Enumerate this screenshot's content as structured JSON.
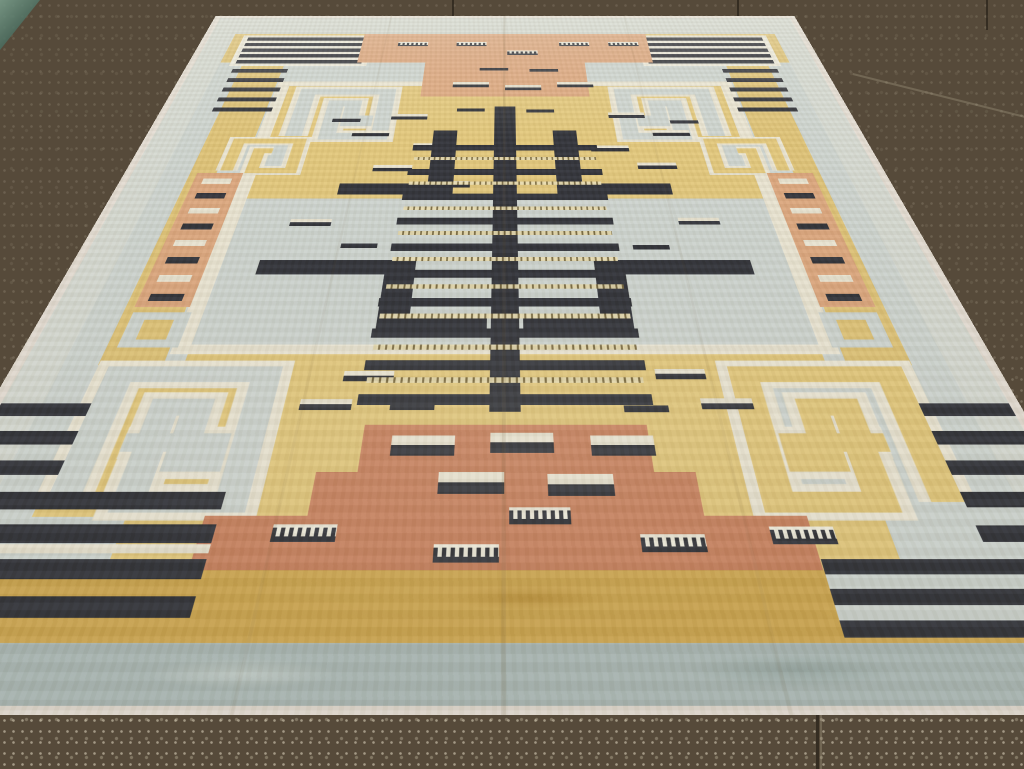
{
  "scene": {
    "type": "photograph",
    "subject": "Art Deco geometric rug displayed flat on a dark speckled stone floor",
    "view": "perspective from the near (bottom) edge, rug receding toward top",
    "floor": "dark olive-brown terrazzo tiles, darker and stained at top, lighter with white speckles at bottom, faint tile joints",
    "reflection": "small teal glass reflection in extreme top-left corner"
  },
  "palette": {
    "binding": "#e4ddd3",
    "outer": "#d6dad2",
    "icy": "#ced5d0",
    "cream": "#eae5d3",
    "white": "#efecdd",
    "yellow": "#dfc377",
    "yellow2": "#e3c87c",
    "salmon": "#dda77e",
    "terra": "#c9825f",
    "navy": "#2f3138",
    "blue": "#abb9b6"
  },
  "rug": {
    "flat_width": 1390,
    "flat_height": 2190,
    "projection": {
      "perspective": 1005,
      "rotateX_deg": 40,
      "bottom_screen_y": 715,
      "center_screen_x": 505
    },
    "ladder": {
      "spine": [
        674,
        575,
        42,
        1085
      ],
      "rungs": [
        [
          520,
          770,
          350
        ],
        [
          517,
          880,
          356
        ],
        [
          514,
          985,
          362
        ],
        [
          511,
          1080,
          368
        ],
        [
          508,
          1175,
          374
        ],
        [
          505,
          1265,
          380
        ],
        [
          502,
          1355,
          386
        ],
        [
          499,
          1445,
          392
        ],
        [
          497,
          1532,
          396
        ],
        [
          495,
          1618,
          400
        ]
      ],
      "ticks": [
        [
          525,
          826,
          340
        ],
        [
          522,
          934,
          346
        ],
        [
          519,
          1036,
          352
        ],
        [
          516,
          1130,
          358
        ],
        [
          513,
          1222,
          364
        ],
        [
          510,
          1312,
          370
        ],
        [
          507,
          1402,
          376
        ],
        [
          505,
          1490,
          380
        ],
        [
          503,
          1576,
          384
        ]
      ]
    },
    "motifs": [
      [
        "rect",
        0,
        0,
        1390,
        2190,
        "binding",
        "rug-binding"
      ],
      [
        "rect",
        14,
        14,
        1362,
        2162,
        "outer",
        "outer-band"
      ],
      [
        "rect",
        70,
        315,
        1250,
        1660,
        "icy",
        "icy-ground"
      ],
      [
        "rect",
        70,
        130,
        1250,
        190,
        "yellow",
        "top-yellow-band"
      ],
      [
        "rect",
        120,
        315,
        92,
        1230,
        "yellow",
        "left-yellow-band"
      ],
      [
        "rect",
        1178,
        315,
        92,
        1230,
        "yellow",
        "right-yellow-band"
      ],
      [
        "rect",
        14,
        1975,
        1362,
        115,
        "ochre",
        "bottom-ochre-band"
      ],
      [
        "rect",
        14,
        2090,
        1362,
        88,
        "blueb",
        "bottom-blue-band"
      ],
      [
        "rect",
        215,
        435,
        960,
        26,
        "cream",
        "field-frame-top"
      ],
      [
        "rect",
        215,
        435,
        26,
        1080,
        "cream",
        "field-frame-left"
      ],
      [
        "rect",
        1149,
        435,
        26,
        1080,
        "cream",
        "field-frame-right"
      ],
      [
        "rect",
        241,
        461,
        908,
        544,
        "yellow2",
        "upper-yellow-field"
      ],
      [
        "rect",
        215,
        1490,
        960,
        26,
        "cream",
        "field-frame-bottom"
      ],
      [
        "rect",
        241,
        1516,
        908,
        459,
        "yellow2",
        "lower-yellow-field"
      ],
      [
        "rect",
        92,
        140,
        300,
        200,
        "white",
        "tl-stripe-panel"
      ],
      [
        "bars",
        104,
        154,
        276,
        0,
        "navy",
        {
          "n": 5,
          "h": 22,
          "gap": 15
        },
        "tl-long-stripes"
      ],
      [
        "rect",
        998,
        140,
        300,
        200,
        "white",
        "tr-stripe-panel"
      ],
      [
        "bars",
        1010,
        154,
        276,
        0,
        "navy",
        {
          "n": 5,
          "h": 22,
          "gap": 15
        },
        "tr-long-stripes"
      ],
      [
        "bars",
        104,
        360,
        120,
        0,
        "navy",
        {
          "n": 5,
          "h": 22,
          "gap": 33
        },
        "left-short-ladder"
      ],
      [
        "bars",
        1166,
        360,
        120,
        0,
        "navy",
        {
          "n": 5,
          "h": 22,
          "gap": 33
        },
        "right-short-ladder"
      ],
      [
        "rect",
        370,
        130,
        650,
        190,
        "salmon",
        "top-salmon-block"
      ],
      [
        "rect",
        520,
        320,
        350,
        200,
        "salmon",
        "top-salmon-step"
      ],
      [
        "comb",
        452,
        185,
        68,
        28
      ],
      [
        "comb",
        585,
        185,
        68,
        28
      ],
      [
        "comb",
        700,
        242,
        68,
        28
      ],
      [
        "comb",
        818,
        185,
        68,
        28
      ],
      [
        "comb",
        930,
        185,
        68,
        28
      ],
      [
        "dash",
        640,
        352,
        62,
        16
      ],
      [
        "dash",
        748,
        360,
        62,
        16
      ],
      [
        "tt",
        585,
        438,
        76,
        30
      ],
      [
        "tt",
        695,
        455,
        76,
        30
      ],
      [
        "tt",
        805,
        438,
        76,
        30
      ],
      [
        "spiral",
        262,
        470,
        212,
        280,
        null,
        {
          "stroke": "icy",
          "casing": "cream",
          "dir": 1,
          "loops": 2.2
        },
        "tl-greek-key"
      ],
      [
        "spiral",
        916,
        470,
        212,
        280,
        null,
        {
          "stroke": "icy",
          "casing": "cream",
          "dir": -1,
          "loops": 2.2
        },
        "tr-greek-key"
      ],
      [
        "spiral",
        168,
        735,
        150,
        168,
        null,
        {
          "stroke": "yellow2",
          "casing": "cream",
          "dir": 1,
          "loops": 1.6,
          "bg": "icy"
        },
        "left-small-key"
      ],
      [
        "spiral",
        1072,
        735,
        150,
        168,
        null,
        {
          "stroke": "yellow2",
          "casing": "cream",
          "dir": -1,
          "loops": 1.6,
          "bg": "icy"
        },
        "right-small-key"
      ],
      [
        "sq",
        135,
        1398,
        88,
        100,
        "icy",
        "left-hollow-square"
      ],
      [
        "sq",
        1167,
        1398,
        88,
        100,
        "icy",
        "right-hollow-square"
      ],
      [
        "dash",
        598,
        586,
        56,
        16
      ],
      [
        "dash",
        738,
        592,
        56,
        16
      ],
      [
        "tt",
        468,
        616,
        72,
        28
      ],
      [
        "tt",
        902,
        608,
        72,
        28
      ],
      [
        "tt",
        398,
        700,
        72,
        28
      ],
      [
        "tt",
        982,
        698,
        72,
        28
      ],
      [
        "tt",
        520,
        762,
        72,
        28
      ],
      [
        "tt",
        858,
        772,
        72,
        28
      ],
      [
        "tt",
        452,
        862,
        72,
        28
      ],
      [
        "tt",
        940,
        852,
        72,
        28
      ],
      [
        "tt",
        560,
        932,
        72,
        28
      ],
      [
        "tt",
        828,
        942,
        72,
        28
      ],
      [
        "dash",
        352,
        640,
        56,
        16
      ],
      [
        "dash",
        1022,
        648,
        56,
        16
      ],
      [
        "rect",
        556,
        700,
        46,
        288,
        "navy",
        "left-step-vert"
      ],
      [
        "rect",
        398,
        942,
        204,
        46,
        "navy",
        "left-step-horiz"
      ],
      [
        "rect",
        788,
        700,
        46,
        288,
        "navy",
        "right-step-vert"
      ],
      [
        "rect",
        788,
        942,
        204,
        46,
        "navy",
        "right-step-horiz"
      ],
      [
        "rect",
        300,
        1232,
        252,
        48,
        "navy",
        "left-zigzag-a"
      ],
      [
        "rect",
        504,
        1232,
        48,
        232,
        "navy",
        "left-zigzag-b"
      ],
      [
        "rect",
        504,
        1416,
        164,
        48,
        "navy",
        "left-zigzag-c"
      ],
      [
        "rect",
        838,
        1232,
        252,
        48,
        "navy",
        "right-zigzag-a"
      ],
      [
        "rect",
        838,
        1232,
        48,
        232,
        "navy",
        "right-zigzag-b"
      ],
      [
        "rect",
        722,
        1416,
        164,
        48,
        "navy",
        "right-zigzag-c"
      ],
      [
        "tt",
        330,
        1085,
        70,
        26
      ],
      [
        "tt",
        990,
        1080,
        70,
        26
      ],
      [
        "dash",
        425,
        1175,
        60,
        16
      ],
      [
        "dash",
        905,
        1180,
        60,
        16
      ],
      [
        "rect",
        133,
        898,
        84,
        484,
        "salmon",
        "left-salmon-ladder"
      ],
      [
        "bars",
        149,
        922,
        52,
        0,
        "alt",
        {
          "n": 8,
          "h": 22,
          "gap": 38,
          "alt": true
        },
        "left-ladder-bars"
      ],
      [
        "rect",
        1173,
        898,
        84,
        484,
        "salmon",
        "right-salmon-ladder"
      ],
      [
        "bars",
        1189,
        922,
        52,
        0,
        "alt",
        {
          "n": 8,
          "h": 22,
          "gap": 38,
          "alt": true
        },
        "right-ladder-bars"
      ],
      [
        "rect",
        128,
        1540,
        262,
        340,
        "yellow2",
        "bl-key-ground"
      ],
      [
        "spiral",
        128,
        1540,
        262,
        340,
        null,
        {
          "stroke": "icy",
          "casing": "cream",
          "dir": 1,
          "loops": 2.4
        },
        "bl-greek-key"
      ],
      [
        "rect",
        1000,
        1540,
        262,
        340,
        "icy",
        "br-key-ground"
      ],
      [
        "spiral",
        1000,
        1540,
        262,
        340,
        null,
        {
          "stroke": "yellow2",
          "casing": "cream",
          "dir": -1,
          "loops": 2.4
        },
        "br-greek-key"
      ],
      [
        "tt",
        470,
        1560,
        70,
        26
      ],
      [
        "tt",
        905,
        1555,
        70,
        26
      ],
      [
        "tt",
        418,
        1630,
        70,
        26
      ],
      [
        "tt",
        960,
        1628,
        70,
        26
      ],
      [
        "dash",
        540,
        1640,
        60,
        16
      ],
      [
        "dash",
        855,
        1645,
        60,
        16
      ],
      [
        "rect",
        510,
        1690,
        372,
        102,
        "terra",
        "terracotta-step1"
      ],
      [
        "rect",
        458,
        1792,
        476,
        86,
        "terra",
        "terracotta-step2"
      ],
      [
        "rect",
        335,
        1878,
        722,
        97,
        "terra",
        "terracotta-step3"
      ],
      [
        "tt",
        548,
        1714,
        82,
        44
      ],
      [
        "tt",
        676,
        1708,
        82,
        44
      ],
      [
        "tt",
        806,
        1714,
        82,
        44
      ],
      [
        "tt",
        612,
        1792,
        82,
        44
      ],
      [
        "tt",
        748,
        1796,
        82,
        44
      ],
      [
        "comb",
        700,
        1862,
        74,
        32
      ],
      [
        "comb",
        420,
        1894,
        76,
        32
      ],
      [
        "comb",
        612,
        1930,
        76,
        32
      ],
      [
        "comb",
        854,
        1912,
        76,
        32
      ],
      [
        "comb",
        1008,
        1898,
        76,
        32
      ],
      [
        "bars",
        14,
        1640,
        122,
        0,
        "navy",
        {
          "n": 3,
          "h": 30,
          "gap": 34
        },
        "left-edge-ladder"
      ],
      [
        "bars",
        1254,
        1640,
        122,
        0,
        "navy",
        {
          "n": 5,
          "h": 30,
          "gap": 34
        },
        "right-edge-ladder"
      ],
      [
        "bars",
        14,
        1832,
        338,
        0,
        "navy",
        {
          "n": 4,
          "h": 34,
          "gap": 28
        },
        "bl-wide-stripes"
      ],
      [
        "rect",
        14,
        1930,
        338,
        16,
        "cream",
        "bl-cream-stripe"
      ],
      [
        "rect",
        1058,
        1956,
        318,
        26,
        "navy",
        "br-stripe-1"
      ],
      [
        "rect",
        1058,
        1982,
        318,
        24,
        "icy",
        "br-gap-1"
      ],
      [
        "rect",
        1058,
        2006,
        318,
        26,
        "navy",
        "br-stripe-2"
      ],
      [
        "rect",
        1058,
        2032,
        318,
        24,
        "icy",
        "br-gap-2"
      ],
      [
        "rect",
        1058,
        2056,
        318,
        26,
        "navy",
        "br-stripe-3"
      ]
    ]
  },
  "floor_joints": [
    {
      "x": 452,
      "y": 0,
      "w": 2,
      "h": 64,
      "kind": "dark"
    },
    {
      "x": 737,
      "y": 0,
      "w": 2,
      "h": 36,
      "kind": "dark"
    },
    {
      "x": 986,
      "y": 0,
      "w": 2,
      "h": 30,
      "kind": "dark"
    },
    {
      "x": 816,
      "y": 475,
      "w": 3,
      "h": 294,
      "kind": "dark"
    },
    {
      "x": 820,
      "y": 475,
      "w": 2,
      "h": 294,
      "kind": "lite"
    },
    {
      "x": 850,
      "y": 96,
      "w": 190,
      "h": 2,
      "kind": "lite",
      "rot": 14
    }
  ]
}
